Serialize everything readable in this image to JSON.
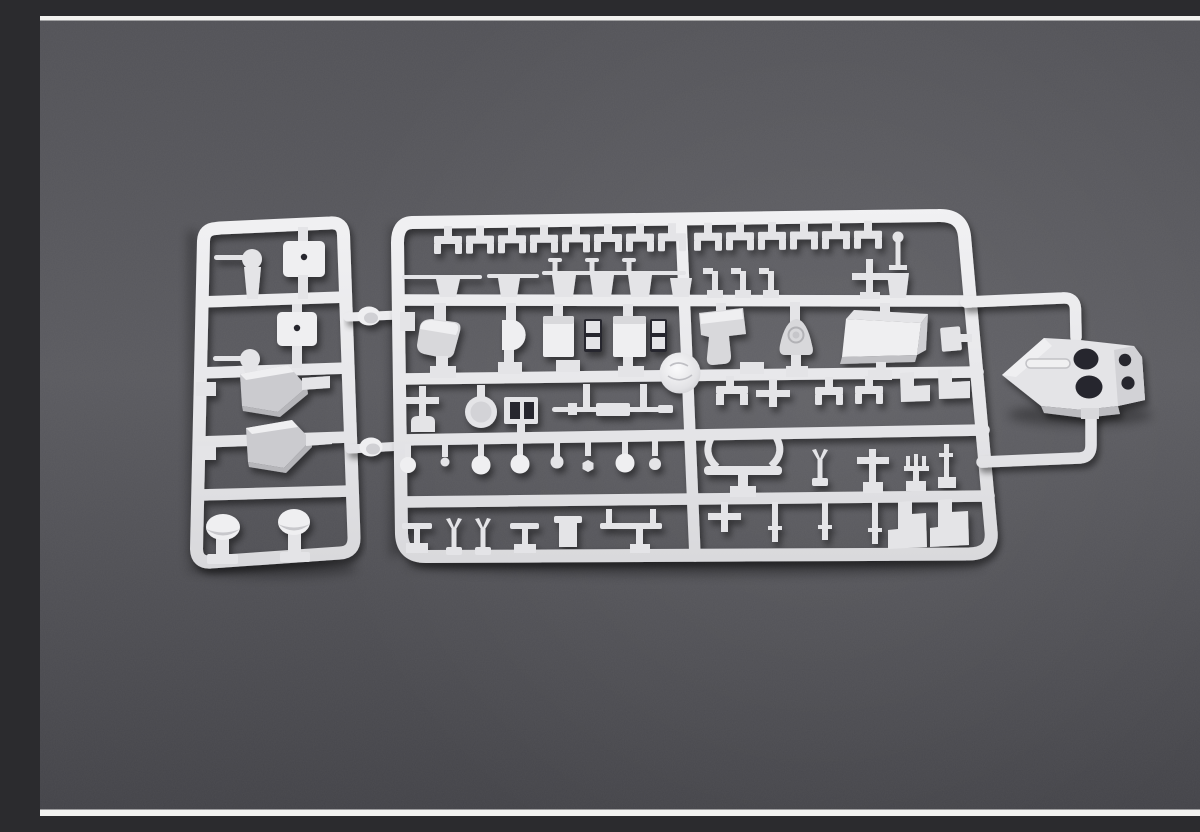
{
  "meta": {
    "description": "Photograph of light gray injection-molded plastic model kit sprues with many small ship detail parts, lying on a dark slate-gray surface. A small rectangular runner frame sits at the left, a large rectangular runner frame fills the center, and a pointed superstructure deck piece with two large and two small round openings is attached at the right. Thin white strips border the top and bottom of the photo."
  },
  "scene": {
    "background": {
      "surface": "dark slate gray",
      "surface_top_color": "#525257",
      "surface_mid_color": "#5a5a5f",
      "surface_bottom_color": "#434348",
      "top_strip_color": "#f2f2f0",
      "bottom_strip_color": "#f2f2f0"
    },
    "plastic": {
      "highlight_color": "#f1f1f3",
      "base_color": "#e4e4e7",
      "shadow_color": "#c6c6ca",
      "opening_color": "#28282d"
    },
    "sprues": [
      {
        "id": "left-runner",
        "shape": "small rounded rectangular frame",
        "cells": 5,
        "parts": [
          "gun mount with barrel",
          "turret roof plate with locating hole",
          "gun mount with barrel",
          "turret roof plate with locating hole",
          "hull wedge block",
          "hull wedge block",
          "mushroom ventilator",
          "mushroom ventilator"
        ]
      },
      {
        "id": "main-runner",
        "shape": "large rounded rectangular frame with five part rows",
        "rows": 5,
        "parts": [
          "deck fitting clips",
          "yardarm and barrel rods",
          "mast with ball finial",
          "cross-shaped fitting",
          "ship's boat half",
          "half-round platform",
          "hatch boxes with tabs",
          "bell-shaped ventilator",
          "deckhouse block",
          "round barbette disc",
          "anchor",
          "searchlight drum",
          "grating frame",
          "gun barrel assembly",
          "sphere fittings",
          "bench-shaped support",
          "forked fairlead",
          "trident fitting",
          "davits, bollards and pins"
        ]
      },
      {
        "id": "deck-section",
        "shape": "pointed superstructure deck piece",
        "features": [
          "two large round openings",
          "two small round openings",
          "molded ridge slot",
          "attachment tab to runner"
        ]
      }
    ],
    "connector_count": 2
  }
}
